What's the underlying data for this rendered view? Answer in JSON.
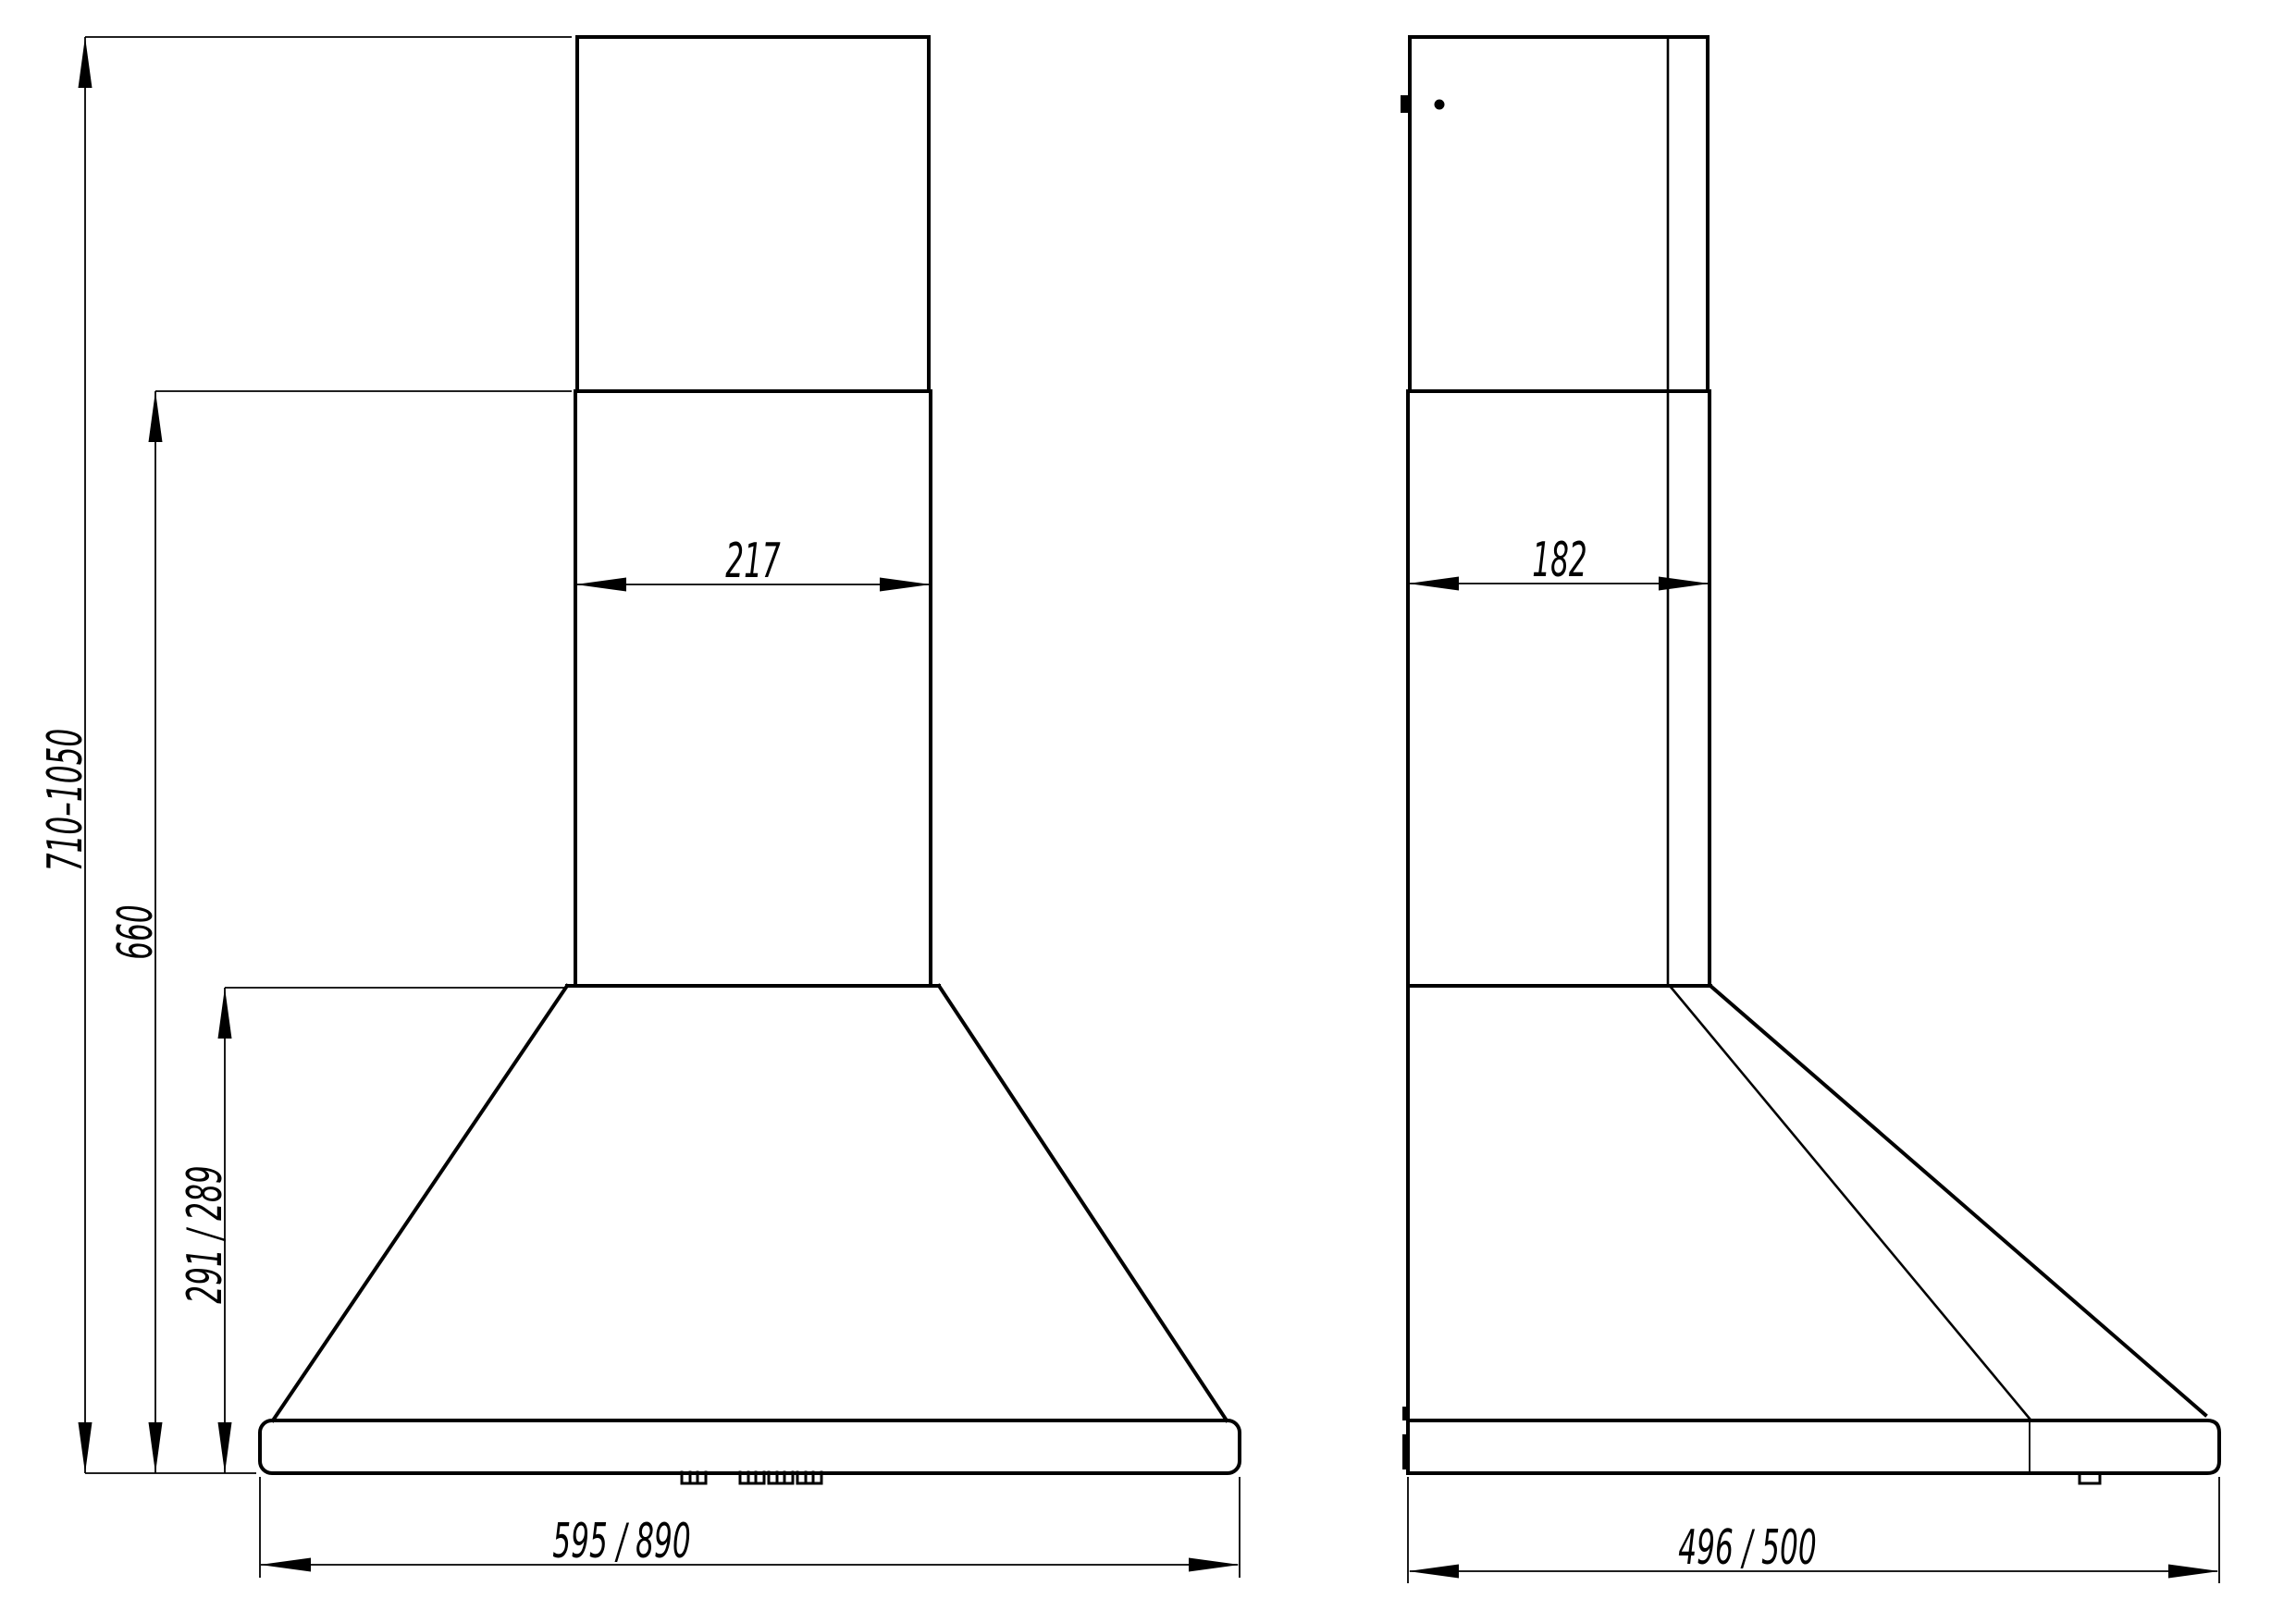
{
  "drawing": {
    "background": "#ffffff",
    "line_color": "#000000",
    "front_view": {
      "chimney_width_label": "217",
      "height_range_label": "710–1050",
      "height_to_canopy_label": "660",
      "canopy_height_label": "291 / 289",
      "body_width_label": "595 / 890"
    },
    "side_view": {
      "chimney_depth_label": "182",
      "body_depth_label": "496 / 500"
    }
  }
}
